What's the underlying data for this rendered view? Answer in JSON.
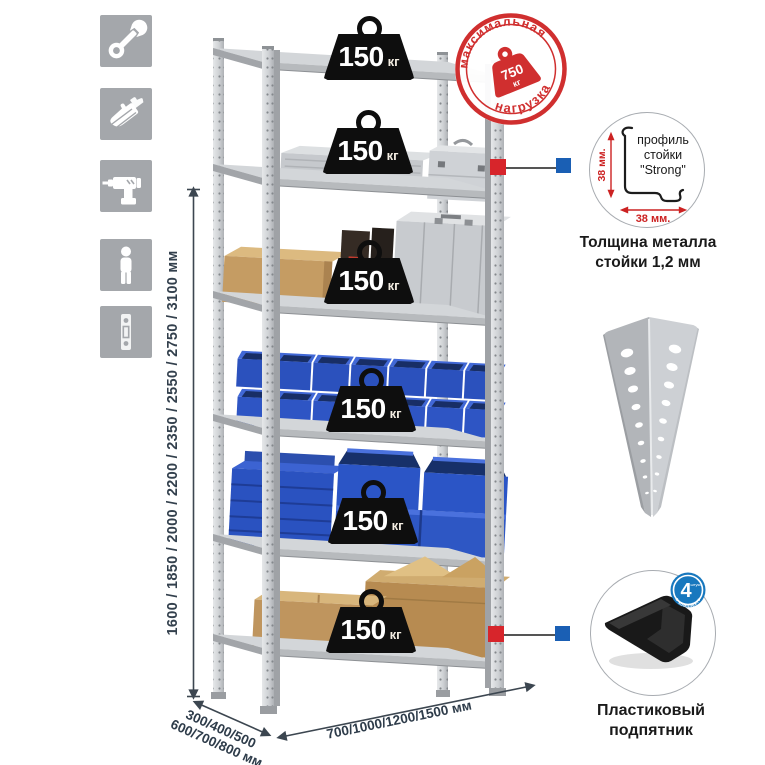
{
  "icon_strip": {
    "color": "#a4a7ab",
    "icons": [
      {
        "name": "wrench-icon"
      },
      {
        "name": "gloves-icon"
      },
      {
        "name": "drill-icon"
      },
      {
        "name": "person-icon"
      },
      {
        "name": "perforated-strip-icon"
      }
    ]
  },
  "height_dimension": {
    "label": "1600 / 1850 / 2000 / 2200 / 2350 / 2550 / 2750 / 3100 мм"
  },
  "depth_dimension": {
    "line1": "300/400/500",
    "line2": "600/700/800 мм"
  },
  "width_dimension": {
    "label": "700/1000/1200/1500 мм"
  },
  "shelves": [
    {
      "load": "150",
      "unit": "кг"
    },
    {
      "load": "150",
      "unit": "кг"
    },
    {
      "load": "150",
      "unit": "кг"
    },
    {
      "load": "150",
      "unit": "кг"
    },
    {
      "load": "150",
      "unit": "кг"
    },
    {
      "load": "150",
      "unit": "кг"
    }
  ],
  "max_load_stamp": {
    "arc_top": "максимальная",
    "arc_bottom": "нагрузка",
    "value": "750",
    "unit": "кг"
  },
  "profile_detail": {
    "caption_line1": "профиль",
    "caption_line2": "стойки",
    "caption_line3": "\"Strong\"",
    "dim_vertical": "38 мм.",
    "dim_horizontal": "38 мм."
  },
  "thickness_caption": {
    "line1": "Толщина металла",
    "line2": "стойки 1,2 мм"
  },
  "kit_badge": {
    "count": "4",
    "count_suffix": "штуки",
    "arc_text": "в комплекте"
  },
  "foot_caption": {
    "line1": "Пластиковый",
    "line2": "подпятник"
  },
  "colors": {
    "accent_red": "#d02f2f",
    "callout_red": "#d7252b",
    "callout_blue": "#1a5fb4",
    "badge_blue": "#1878be",
    "bin_blue": "#2b52c0",
    "icon_gray": "#a4a7ab"
  }
}
